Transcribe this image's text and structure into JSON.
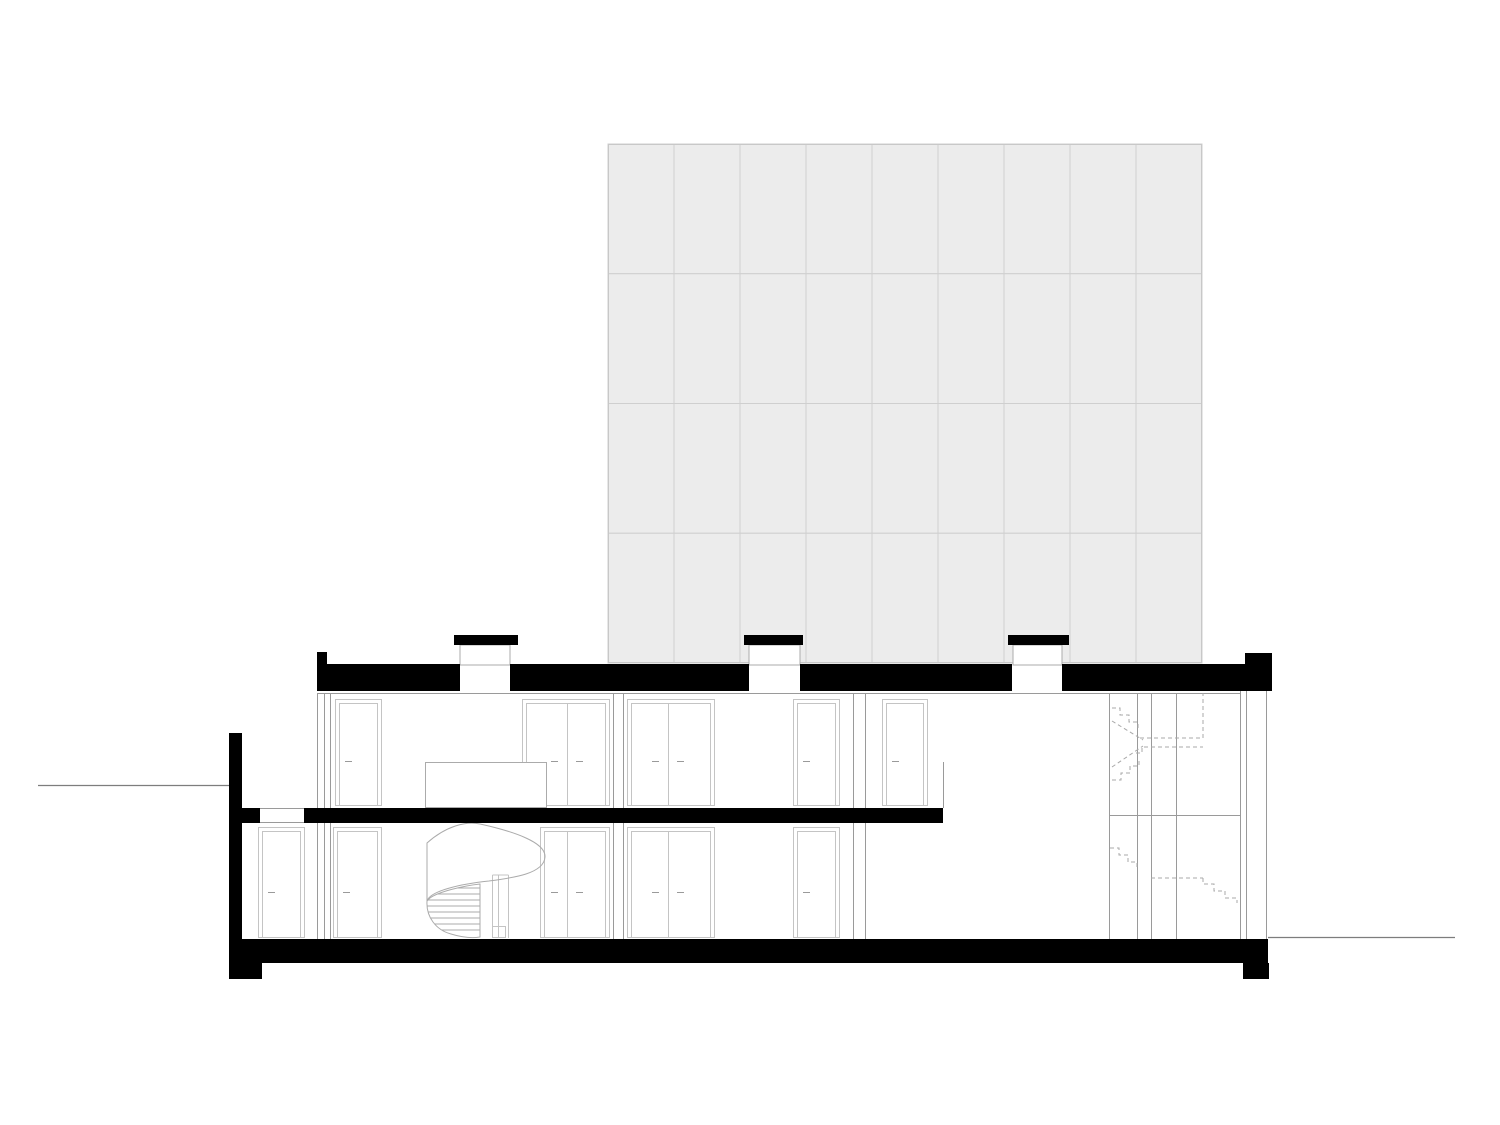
{
  "drawing": {
    "type": "building cross-section",
    "background": "#ffffff",
    "width": 1500,
    "height": 1125
  },
  "colors": {
    "ink": "#000000",
    "wall_line": "#9a9a9a",
    "frame_line": "#c4c4c4",
    "detail_line": "#ababab",
    "dashed_line": "#a8a8a8",
    "ground_line": "#7d7d7d",
    "panel_fill": "#ececec",
    "panel_line": "#cfcfcf",
    "panel_border": "#c8c8c8"
  },
  "facade_grid": {
    "x": 608,
    "y": 144,
    "width": 594,
    "height": 519,
    "columns": 9,
    "rows": 4
  },
  "skylights": [
    {
      "cap_x": 454,
      "cap_w": 64,
      "shaft_x": 460,
      "shaft_w": 50
    },
    {
      "cap_x": 744,
      "cap_w": 59,
      "shaft_x": 749,
      "shaft_w": 51
    },
    {
      "cap_x": 1008,
      "cap_w": 61,
      "shaft_x": 1013,
      "shaft_w": 49
    }
  ],
  "doors": {
    "upper": {
      "top": 699,
      "height": 107,
      "handle_y": 761,
      "items": [
        {
          "x": 335,
          "w": 47
        },
        {
          "x": 522,
          "w": 88,
          "divider": 567
        },
        {
          "x": 627,
          "w": 88,
          "divider": 668
        },
        {
          "x": 793,
          "w": 47
        },
        {
          "x": 882,
          "w": 46
        }
      ]
    },
    "lower": {
      "top": 827,
      "height": 111,
      "handle_y": 892,
      "items": [
        {
          "x": 258,
          "w": 47
        },
        {
          "x": 333,
          "w": 49
        },
        {
          "x": 540,
          "w": 70,
          "divider": 567
        },
        {
          "x": 627,
          "w": 88,
          "divider": 668
        },
        {
          "x": 793,
          "w": 47
        }
      ]
    }
  },
  "ink_shapes": {
    "roof_segments": [
      {
        "x": 318,
        "y": 664,
        "w": 142,
        "h": 27
      },
      {
        "x": 510,
        "y": 664,
        "w": 239,
        "h": 27
      },
      {
        "x": 800,
        "y": 664,
        "w": 212,
        "h": 27
      },
      {
        "x": 1062,
        "y": 664,
        "w": 183,
        "h": 27
      }
    ],
    "parapet_left": {
      "x": 317,
      "y": 652,
      "w": 10,
      "h": 39
    },
    "parapet_right": {
      "x": 1245,
      "y": 653,
      "w": 27,
      "h": 38
    },
    "mid_slab": [
      {
        "x": 242,
        "y": 808,
        "w": 18,
        "h": 15
      },
      {
        "x": 304,
        "y": 808,
        "w": 639,
        "h": 15
      }
    ],
    "retaining_wall": {
      "x": 229,
      "y": 733,
      "w": 13,
      "h": 230
    },
    "bottom_slab": {
      "x": 230,
      "y": 939,
      "w": 1038,
      "h": 24
    },
    "footing_left": {
      "x": 229,
      "y": 963,
      "w": 33,
      "h": 16
    },
    "footing_right": {
      "x": 1243,
      "y": 963,
      "w": 26,
      "h": 16
    }
  },
  "ground_lines": {
    "left": {
      "x1": 38,
      "y": 785.5,
      "x2": 229
    },
    "right": {
      "x1": 1268,
      "y": 937.5,
      "x2": 1455
    }
  }
}
